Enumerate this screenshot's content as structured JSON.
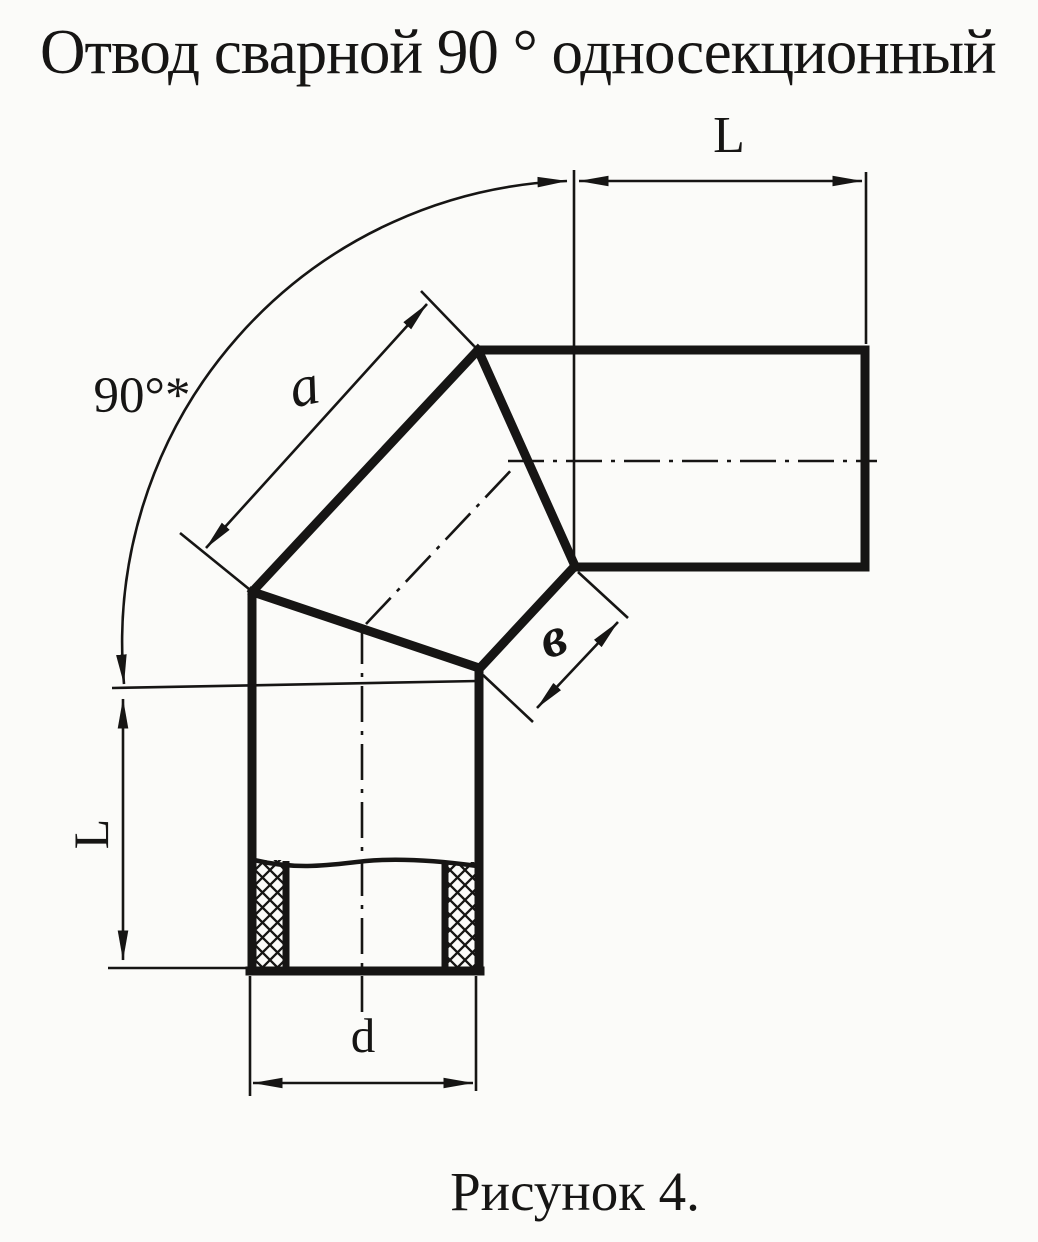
{
  "title": "Отвод сварной 90 ° односекционный",
  "caption": "Рисунок 4.",
  "drawing": {
    "kind": "welded 90-degree single-section pipe elbow, dimensioned technical drawing",
    "labels": {
      "length_top": "L",
      "length_left": "L",
      "section_side": "a",
      "section_width": "в",
      "diameter": "d",
      "angle": "90°*"
    }
  },
  "colors": {
    "ink": "#161514",
    "paper": "#fbfbf9"
  }
}
